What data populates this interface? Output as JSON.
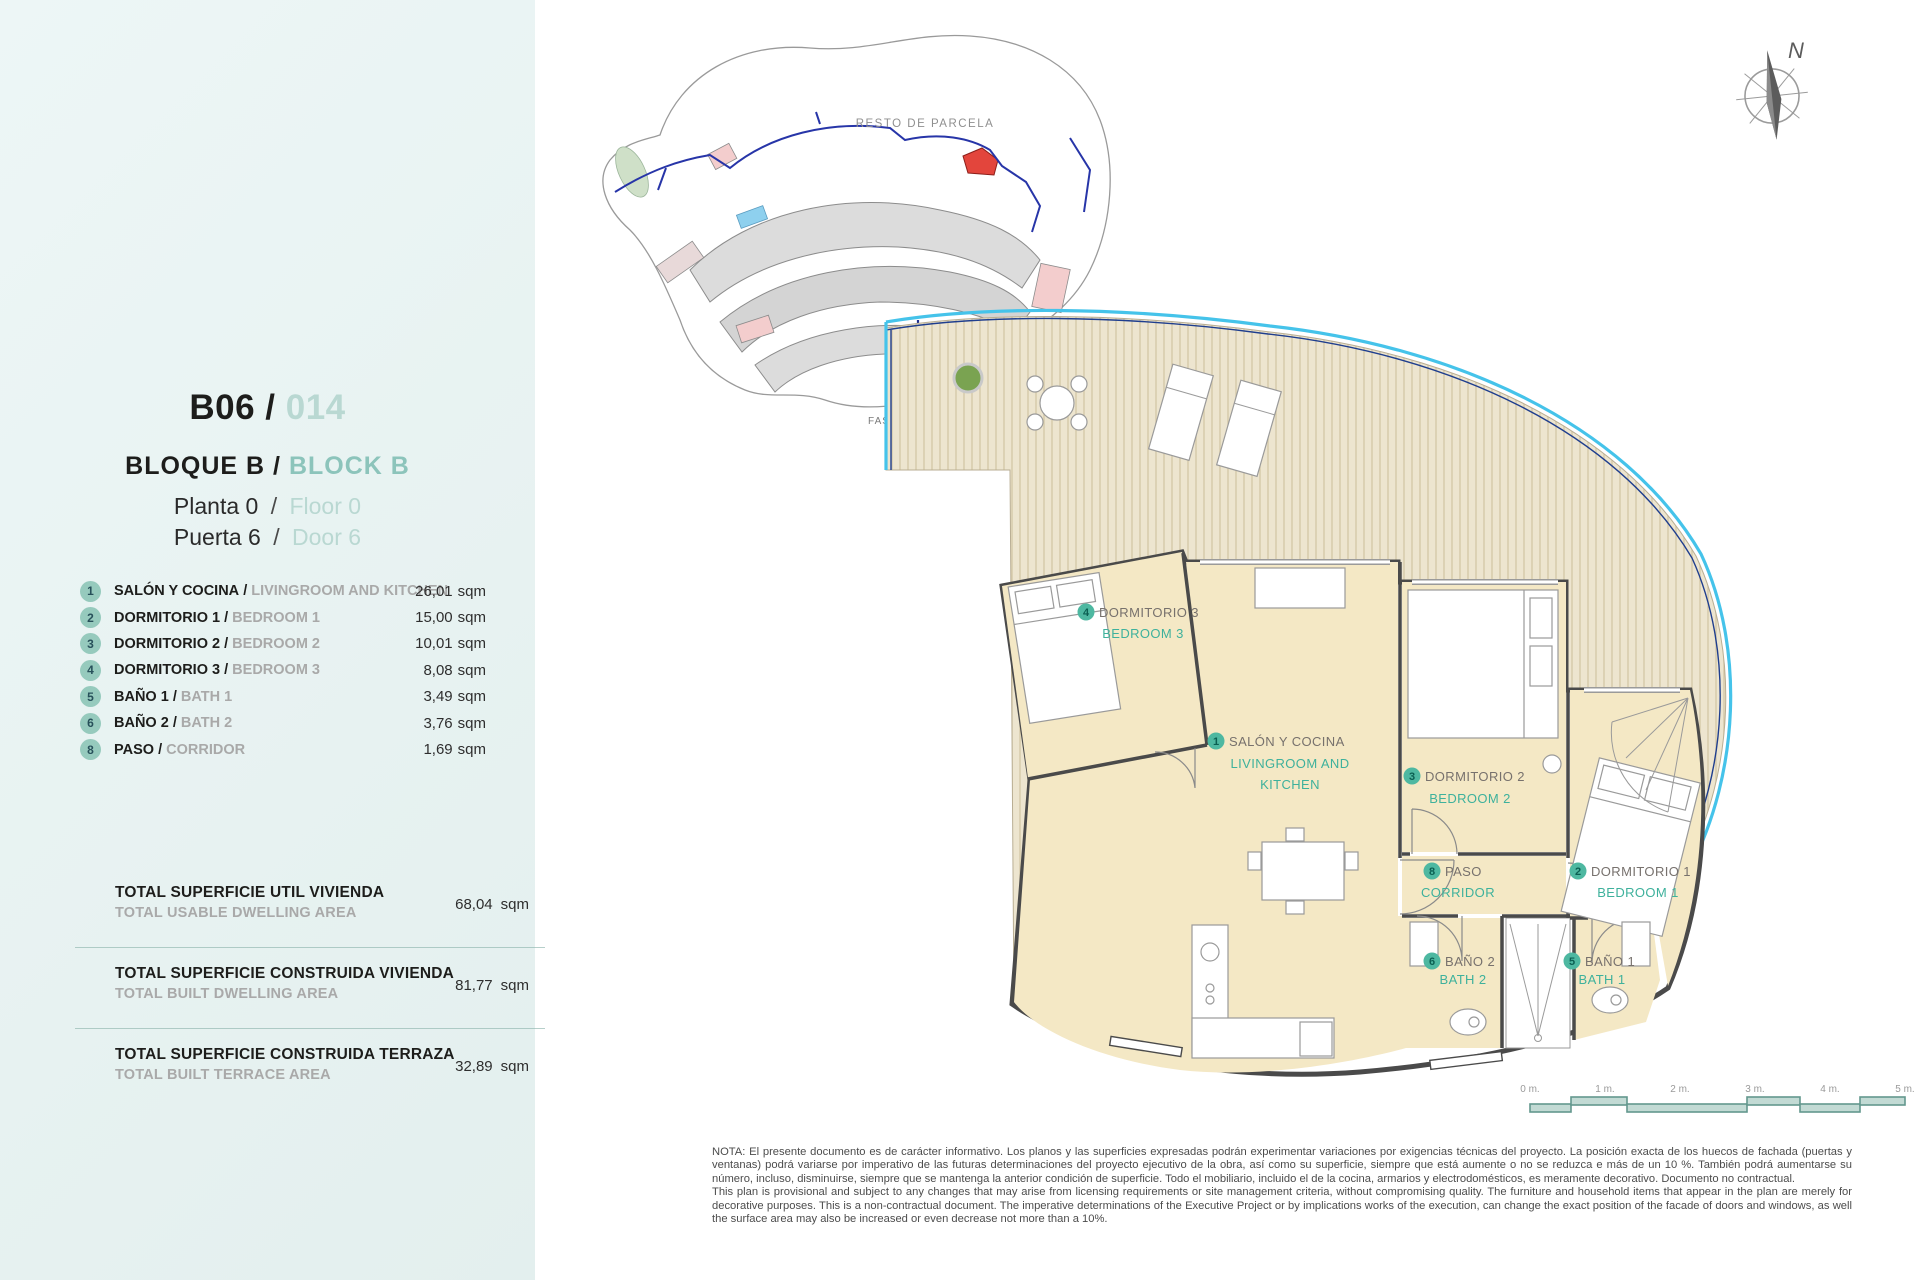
{
  "misc": {
    "slash": "/"
  },
  "sidebar": {
    "unit_code": "B06",
    "unit_number": "014",
    "block_es": "BLOQUE B",
    "block_en": "BLOCK B",
    "floor_es": "Planta 0",
    "floor_en": "Floor 0",
    "door_es": "Puerta 6",
    "door_en": "Door 6",
    "rooms": [
      {
        "num": "1",
        "es": "SALÓN Y COCINA",
        "en": "LIVINGROOM AND KITCHEN",
        "area": "26,01",
        "unit": "sqm"
      },
      {
        "num": "2",
        "es": "DORMITORIO 1",
        "en": "BEDROOM 1",
        "area": "15,00",
        "unit": "sqm"
      },
      {
        "num": "3",
        "es": "DORMITORIO 2",
        "en": "BEDROOM 2",
        "area": "10,01",
        "unit": "sqm"
      },
      {
        "num": "4",
        "es": "DORMITORIO 3",
        "en": "BEDROOM 3",
        "area": "8,08",
        "unit": "sqm"
      },
      {
        "num": "5",
        "es": "BAÑO 1",
        "en": "BATH 1",
        "area": "3,49",
        "unit": "sqm"
      },
      {
        "num": "6",
        "es": "BAÑO 2",
        "en": "BATH 2",
        "area": "3,76",
        "unit": "sqm"
      },
      {
        "num": "8",
        "es": "PASO",
        "en": "CORRIDOR",
        "area": "1,69",
        "unit": "sqm"
      }
    ],
    "totals": [
      {
        "es": "TOTAL SUPERFICIE UTIL VIVIENDA",
        "en": "TOTAL USABLE DWELLING AREA",
        "value": "68,04",
        "unit": "sqm"
      },
      {
        "es": "TOTAL SUPERFICIE CONSTRUIDA VIVIENDA",
        "en": "TOTAL BUILT DWELLING AREA",
        "value": "81,77",
        "unit": "sqm"
      },
      {
        "es": "TOTAL SUPERFICIE CONSTRUIDA TERRAZA",
        "en": "TOTAL BUILT TERRACE AREA",
        "value": "32,89",
        "unit": "sqm"
      }
    ]
  },
  "site_plan": {
    "parcel_label": "RESTO DE PARCELA",
    "phase1": "FASE 1",
    "phase2": "FASE 2"
  },
  "compass": {
    "north": "N"
  },
  "plan": {
    "labels": [
      {
        "num": "4",
        "es": "DORMITORIO 3",
        "en": "BEDROOM 3"
      },
      {
        "num": "1",
        "es": "SALÓN Y COCINA",
        "en1": "LIVINGROOM AND",
        "en2": "KITCHEN"
      },
      {
        "num": "3",
        "es": "DORMITORIO 2",
        "en": "BEDROOM 2"
      },
      {
        "num": "8",
        "es": "PASO",
        "en": "CORRIDOR"
      },
      {
        "num": "2",
        "es": "DORMITORIO 1",
        "en": "BEDROOM 1"
      },
      {
        "num": "6",
        "es": "BAÑO 2",
        "en": "BATH 2"
      },
      {
        "num": "5",
        "es": "BAÑO 1",
        "en": "BATH 1"
      }
    ]
  },
  "scale_bar": {
    "ticks": [
      "0 m.",
      "1 m.",
      "2 m.",
      "3 m.",
      "4 m.",
      "5 m."
    ]
  },
  "note": {
    "es": "NOTA: El presente documento es de carácter informativo. Los planos y las superficies expresadas podrán experimentar variaciones por exigencias técnicas del proyecto. La posición exacta de los huecos de fachada (puertas y ventanas) podrá variarse por imperativo de las futuras determinaciones del proyecto ejecutivo de la obra, así como su superficie, siempre que está aumente o no se reduzca e más de un 10 %. También podrá aumentarse su número, incluso, disminuirse, siempre que se mantenga la anterior condición de superficie. Todo el mobiliario, incluido el de la cocina, armarios y electrodomésticos, es meramente decorativo. Documento no contractual.",
    "en": "This plan is provisional and subject to any changes that may arise from licensing requirements or site management criteria, without compromising quality. The furniture and household items that appear in the plan are merely for decorative purposes. This is a non-contractual document. The imperative determinations of the Executive Project or by implications works of the execution, can change the exact position of the facade of doors and windows, as well the surface area may also be increased or even decrease not more than a 10%."
  },
  "colors": {
    "sidebar_bg": "#e8f2f1",
    "accent_teal": "#3eb19c",
    "pale_teal": "#b9d8d2",
    "mid_teal": "#8cc4bb",
    "badge_mint": "#96cabd",
    "room_cream": "#f4e8c5",
    "deck_tan": "#d6c9a8",
    "wall": "#4a4a4a",
    "water_cyan": "#45c3ea",
    "water_navy": "#1f3e8e",
    "highlight_red": "#e3453c",
    "gray_text": "#a9a9a9"
  }
}
